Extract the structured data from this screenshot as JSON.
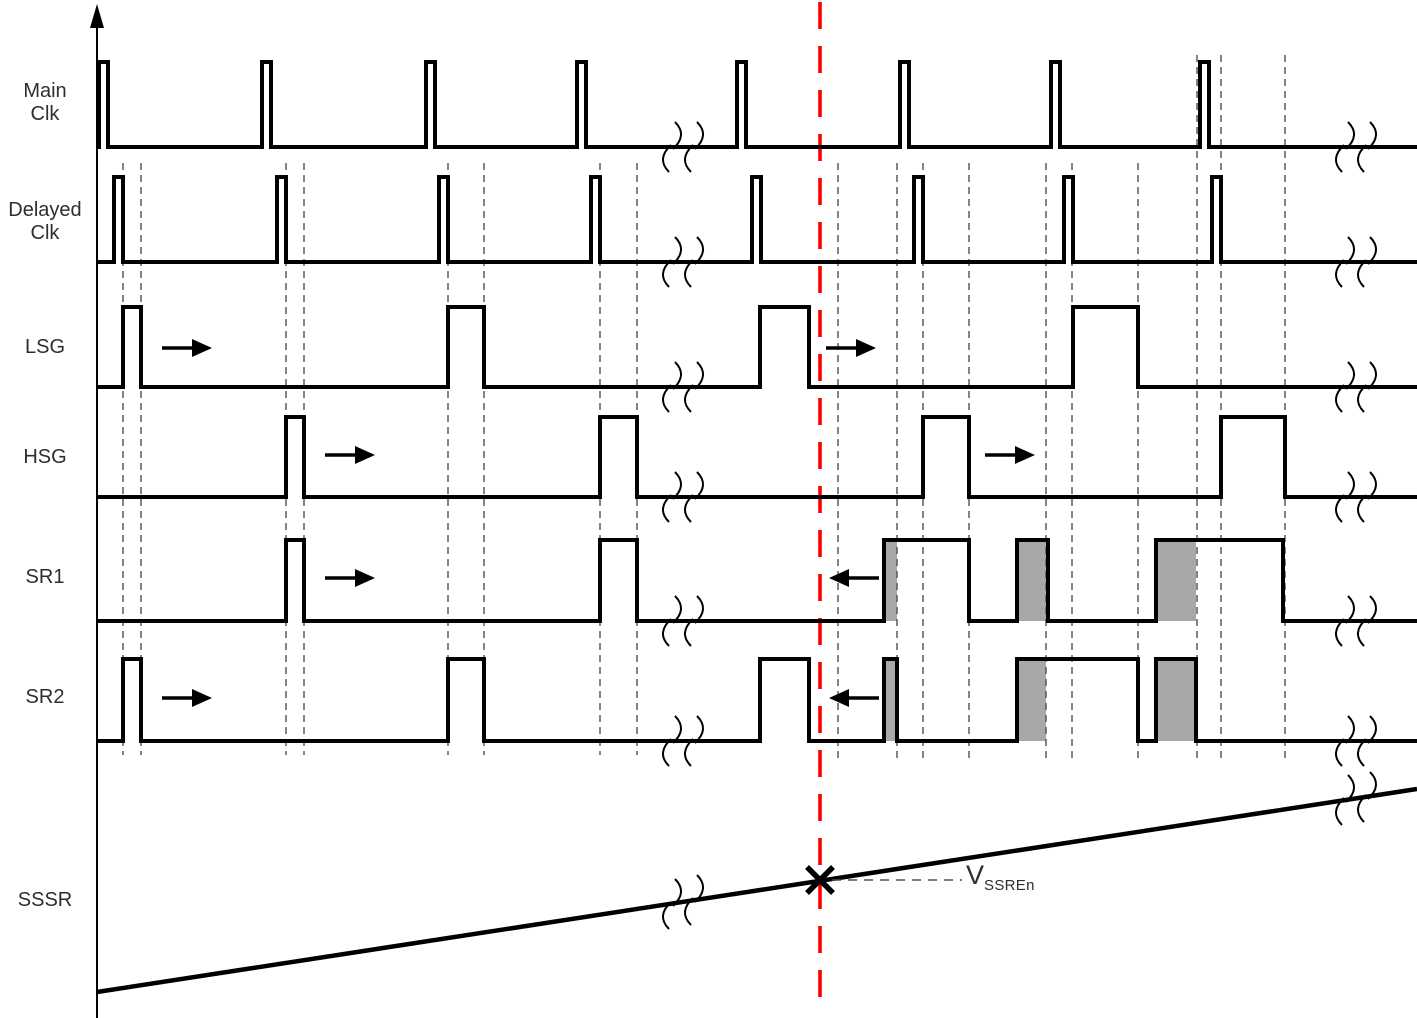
{
  "diagram_type": "timing-diagram",
  "colors": {
    "waveform": "#000000",
    "gray_fill": "#a8a8a8",
    "guide": "#4f4f4f",
    "red_event": "#ff0000",
    "text": "#2e2e2e"
  },
  "layout": {
    "width": 1417,
    "height": 1018,
    "axis_x": 97,
    "x_end": 1417
  },
  "signals": [
    {
      "id": "main-clk",
      "lines": [
        "Main",
        "Clk"
      ],
      "label_cy": 103,
      "base": 147,
      "high": 62,
      "pulses": [
        [
          99,
          108
        ],
        [
          262,
          271
        ],
        [
          426,
          435
        ],
        [
          577,
          586
        ],
        [
          737,
          746
        ],
        [
          900,
          909
        ],
        [
          1051,
          1060
        ],
        [
          1200,
          1209
        ]
      ]
    },
    {
      "id": "delayed-clk",
      "lines": [
        "Delayed",
        "Clk"
      ],
      "label_cy": 222,
      "base": 262,
      "high": 177,
      "pulses": [
        [
          114,
          123
        ],
        [
          277,
          286
        ],
        [
          439,
          448
        ],
        [
          591,
          600
        ],
        [
          752,
          761
        ],
        [
          914,
          923
        ],
        [
          1064,
          1073
        ],
        [
          1212,
          1221
        ]
      ]
    },
    {
      "id": "lsg",
      "lines": [
        "LSG"
      ],
      "label_cy": 347,
      "base": 387,
      "high": 307,
      "pulses": [
        [
          123,
          141
        ],
        [
          448,
          484
        ],
        [
          760,
          809
        ],
        [
          1073,
          1138
        ]
      ]
    },
    {
      "id": "hsg",
      "lines": [
        "HSG"
      ],
      "label_cy": 457,
      "base": 497,
      "high": 417,
      "pulses": [
        [
          286,
          304
        ],
        [
          600,
          637
        ],
        [
          923,
          969
        ],
        [
          1221,
          1285
        ]
      ]
    },
    {
      "id": "sr1",
      "lines": [
        "SR1"
      ],
      "label_cy": 577,
      "base": 621,
      "high": 540,
      "pulses": [
        [
          286,
          304
        ],
        [
          600,
          637
        ],
        [
          884,
          969
        ],
        [
          1017,
          1048
        ],
        [
          1156,
          1283
        ]
      ],
      "gray": [
        [
          884,
          897
        ],
        [
          1017,
          1046
        ],
        [
          1156,
          1196
        ]
      ]
    },
    {
      "id": "sr2",
      "lines": [
        "SR2"
      ],
      "label_cy": 697,
      "base": 741,
      "high": 659,
      "pulses": [
        [
          123,
          141
        ],
        [
          448,
          484
        ],
        [
          760,
          809
        ],
        [
          884,
          897
        ],
        [
          1017,
          1138
        ],
        [
          1156,
          1196
        ]
      ],
      "gray": [
        [
          884,
          897
        ],
        [
          1017,
          1046
        ],
        [
          1156,
          1196
        ]
      ]
    }
  ],
  "ramp": {
    "id": "sssr",
    "lines": [
      "SSSR"
    ],
    "label_cy": 900,
    "x1": 97,
    "y1": 992,
    "x2": 1417,
    "y2": 789
  },
  "axis": {
    "x": 97,
    "y_top": 28,
    "y_bottom": 1018,
    "arrow_tip_y": 4
  },
  "red_line": {
    "x": 820,
    "y1": 2,
    "y2": 1012,
    "width": 3.6,
    "dash": "27,17"
  },
  "marker": {
    "x": 820,
    "y": 880,
    "size": 13,
    "width": 5.5
  },
  "vssren": {
    "base": "V",
    "sub": "SSREn",
    "label_x": 966,
    "label_y": 860,
    "leader_x1": 832,
    "leader_x2": 962,
    "leader_y": 880
  },
  "arrows": [
    {
      "x1": 162,
      "x2": 212,
      "y": 348,
      "dir": "right",
      "row": "lsg"
    },
    {
      "x1": 325,
      "x2": 375,
      "y": 455,
      "dir": "right",
      "row": "hsg"
    },
    {
      "x1": 325,
      "x2": 375,
      "y": 578,
      "dir": "right",
      "row": "sr1"
    },
    {
      "x1": 162,
      "x2": 212,
      "y": 698,
      "dir": "right",
      "row": "sr2"
    },
    {
      "x1": 826,
      "x2": 876,
      "y": 348,
      "dir": "right",
      "row": "lsg"
    },
    {
      "x1": 985,
      "x2": 1035,
      "y": 455,
      "dir": "right",
      "row": "hsg"
    },
    {
      "x1": 829,
      "x2": 879,
      "y": 578,
      "dir": "left",
      "row": "sr1"
    },
    {
      "x1": 829,
      "x2": 879,
      "y": 698,
      "dir": "left",
      "row": "sr2"
    }
  ],
  "breaks": [
    {
      "x": 672,
      "y": 147
    },
    {
      "x": 694,
      "y": 147
    },
    {
      "x": 672,
      "y": 262
    },
    {
      "x": 694,
      "y": 262
    },
    {
      "x": 672,
      "y": 387
    },
    {
      "x": 694,
      "y": 387
    },
    {
      "x": 672,
      "y": 497
    },
    {
      "x": 694,
      "y": 497
    },
    {
      "x": 672,
      "y": 621
    },
    {
      "x": 694,
      "y": 621
    },
    {
      "x": 672,
      "y": 741
    },
    {
      "x": 694,
      "y": 741
    },
    {
      "x": 672,
      "y": 904
    },
    {
      "x": 694,
      "y": 900
    },
    {
      "x": 1345,
      "y": 147
    },
    {
      "x": 1367,
      "y": 147
    },
    {
      "x": 1345,
      "y": 262
    },
    {
      "x": 1367,
      "y": 262
    },
    {
      "x": 1345,
      "y": 387
    },
    {
      "x": 1367,
      "y": 387
    },
    {
      "x": 1345,
      "y": 497
    },
    {
      "x": 1367,
      "y": 497
    },
    {
      "x": 1345,
      "y": 621
    },
    {
      "x": 1367,
      "y": 621
    },
    {
      "x": 1345,
      "y": 741
    },
    {
      "x": 1367,
      "y": 741
    },
    {
      "x": 1345,
      "y": 800
    },
    {
      "x": 1367,
      "y": 797
    }
  ],
  "guides": [
    {
      "x": 123,
      "y1": 163,
      "y2": 755
    },
    {
      "x": 141,
      "y1": 163,
      "y2": 755
    },
    {
      "x": 286,
      "y1": 163,
      "y2": 755
    },
    {
      "x": 304,
      "y1": 163,
      "y2": 755
    },
    {
      "x": 448,
      "y1": 163,
      "y2": 755
    },
    {
      "x": 484,
      "y1": 163,
      "y2": 755
    },
    {
      "x": 600,
      "y1": 163,
      "y2": 755
    },
    {
      "x": 637,
      "y1": 163,
      "y2": 755
    },
    {
      "x": 838,
      "y1": 163,
      "y2": 758
    },
    {
      "x": 897,
      "y1": 163,
      "y2": 758
    },
    {
      "x": 923,
      "y1": 163,
      "y2": 758
    },
    {
      "x": 969,
      "y1": 163,
      "y2": 758
    },
    {
      "x": 1046,
      "y1": 163,
      "y2": 758
    },
    {
      "x": 1072,
      "y1": 163,
      "y2": 758
    },
    {
      "x": 1138,
      "y1": 163,
      "y2": 758
    },
    {
      "x": 1197,
      "y1": 55,
      "y2": 758
    },
    {
      "x": 1221,
      "y1": 55,
      "y2": 758
    },
    {
      "x": 1285,
      "y1": 55,
      "y2": 758
    }
  ]
}
